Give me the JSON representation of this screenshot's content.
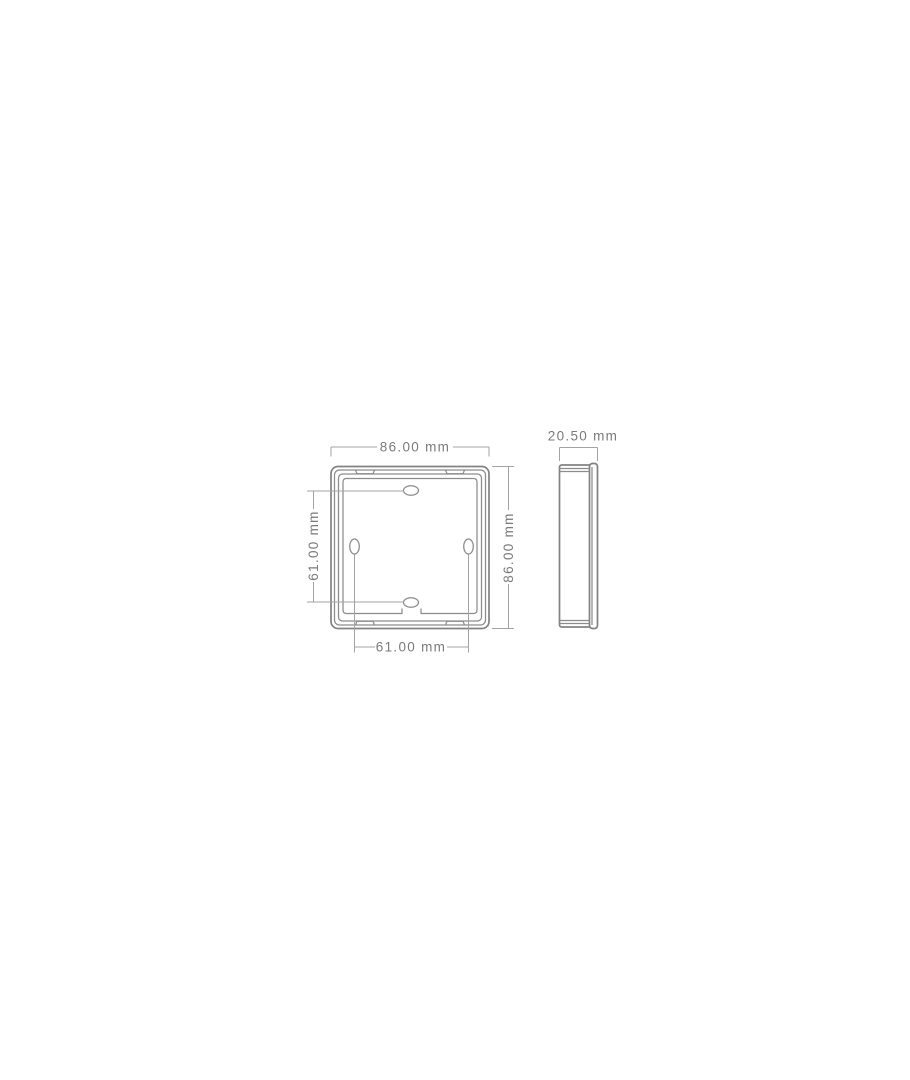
{
  "page": {
    "background_color": "#ffffff",
    "content": "technical dimension drawing of a square wall-mount back plate, front view and side view"
  },
  "drawing": {
    "units": "mm",
    "front_view": {
      "name": "front view of mounting plate",
      "outer_width_label": "86.00 mm",
      "outer_height_label": "86.00 mm",
      "slot_spacing_vertical_label": "61.00 mm",
      "slot_spacing_horizontal_label": "61.00 mm",
      "features": {
        "nested_frame_lines": 4,
        "mounting_slots": [
          "top-center horizontal oval",
          "middle-left vertical oval",
          "middle-right vertical oval",
          "bottom-center horizontal oval"
        ],
        "clip_tabs": [
          "top-left",
          "top-right",
          "bottom-left",
          "bottom-right"
        ],
        "bottom_center_cable_notch": true
      }
    },
    "side_view": {
      "name": "side profile of mounting plate",
      "depth_label": "20.50 mm",
      "features": {
        "front_plate_strip": "right edge, rounded corners",
        "edge_lines": "double lines near top and bottom"
      }
    },
    "colors": {
      "body_line": "#828282",
      "detail_line": "#8c8c8c",
      "dimension_line": "#a3a3a3",
      "text": "#7a7a7a"
    }
  }
}
